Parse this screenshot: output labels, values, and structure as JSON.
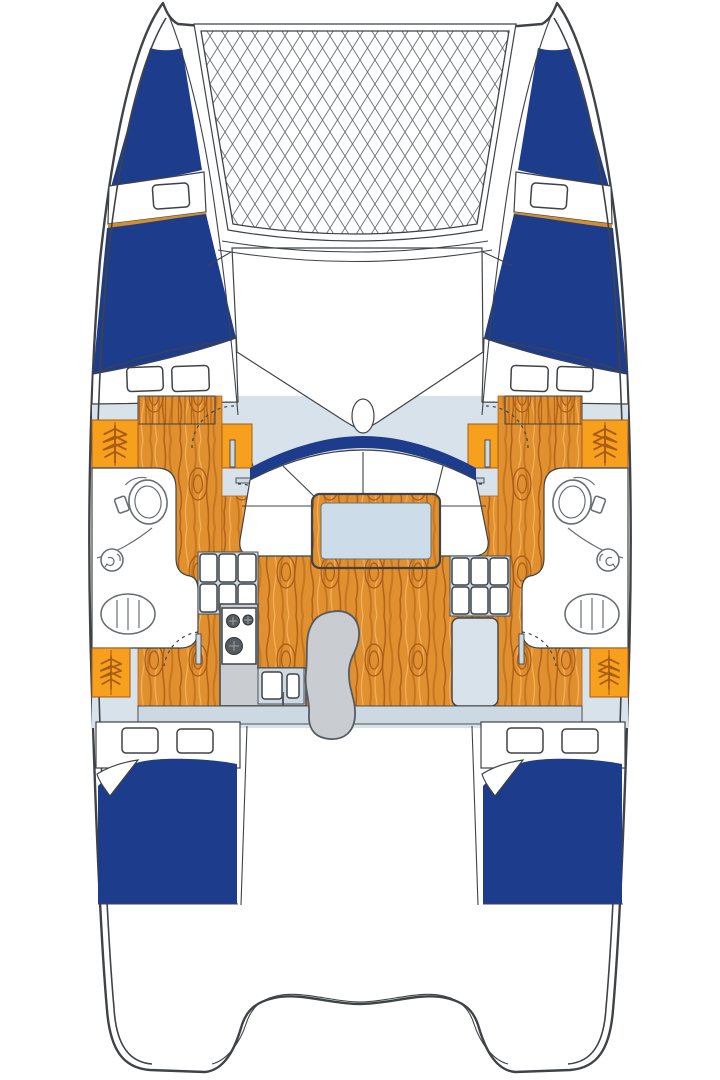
{
  "page": {
    "title": "Catamaran deck plan - top view floor plan diagram",
    "background": "#ffffff"
  },
  "colors": {
    "white": "#ffffff",
    "outline": "#3f4347",
    "navy": "#1e3c8c",
    "deck_blue": "#d8e2ea",
    "panel_blue": "#cdd9e2",
    "table_blue": "#ccdce8",
    "orange": "#f6a01e",
    "stripe": "#d08f2e",
    "wood": "#e0902f",
    "wood_dark": "#b2641c",
    "wood_mid": "#c67722",
    "wood_light": "#f5b15e",
    "wood_knot": "#a85a16",
    "gray": "#c9cdd1",
    "gray_dark": "#565b60",
    "net": "#6b7075",
    "fixture": "#6a6f74"
  },
  "boat": {
    "view": "top-down, bow at top",
    "type": "sailing catamaran interior floor plan",
    "features": {
      "trampoline": "bow trampoline net between hulls",
      "mast_base": "oval mast fitting forward of coachroof",
      "saloon": "U-shaped settee with rectangular table",
      "galley": "3-burner stove, double sink, storage locker grids",
      "heads": "2 bathrooms, each with toilet, shower drain and washbasin",
      "berths": "2 forward berths and 2 aft double berths with navy bedding",
      "wardrobes": "orange hanging lockers with clothes-hanger symbols",
      "cockpit": "aft cockpit with curved transom steps"
    }
  }
}
